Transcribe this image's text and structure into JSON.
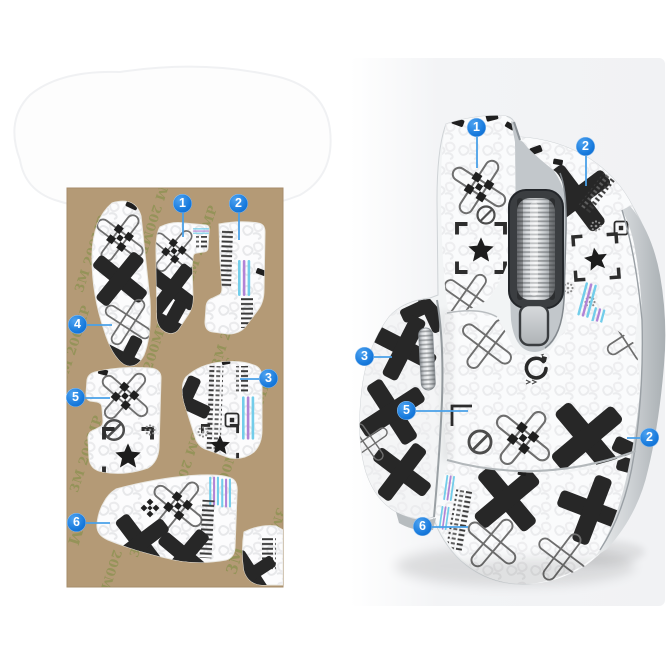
{
  "scene": {
    "description_left": "sticker sheet on kraft adhesive backing",
    "description_right": "mouse with grip stickers applied"
  },
  "sheet": {
    "watermark_text": "3M 200MP",
    "brand_text": "3M",
    "backing_color": "#b49a76",
    "callouts": [
      {
        "label": "1"
      },
      {
        "label": "2"
      },
      {
        "label": "3"
      },
      {
        "label": "4"
      },
      {
        "label": "5"
      },
      {
        "label": "6"
      }
    ]
  },
  "mouse": {
    "callouts": [
      {
        "label": "1"
      },
      {
        "label": "2"
      },
      {
        "label": "3"
      },
      {
        "label": "5"
      },
      {
        "label": "2"
      },
      {
        "label": "6"
      }
    ]
  },
  "colors": {
    "badge_blue": "#1679dc",
    "leader_blue": "#49a0e8",
    "stripe_cyan": "#72cdea",
    "stripe_purple": "#b184d6",
    "pattern_black": "#272727",
    "backdrop_gray": "#f2f3f5"
  }
}
